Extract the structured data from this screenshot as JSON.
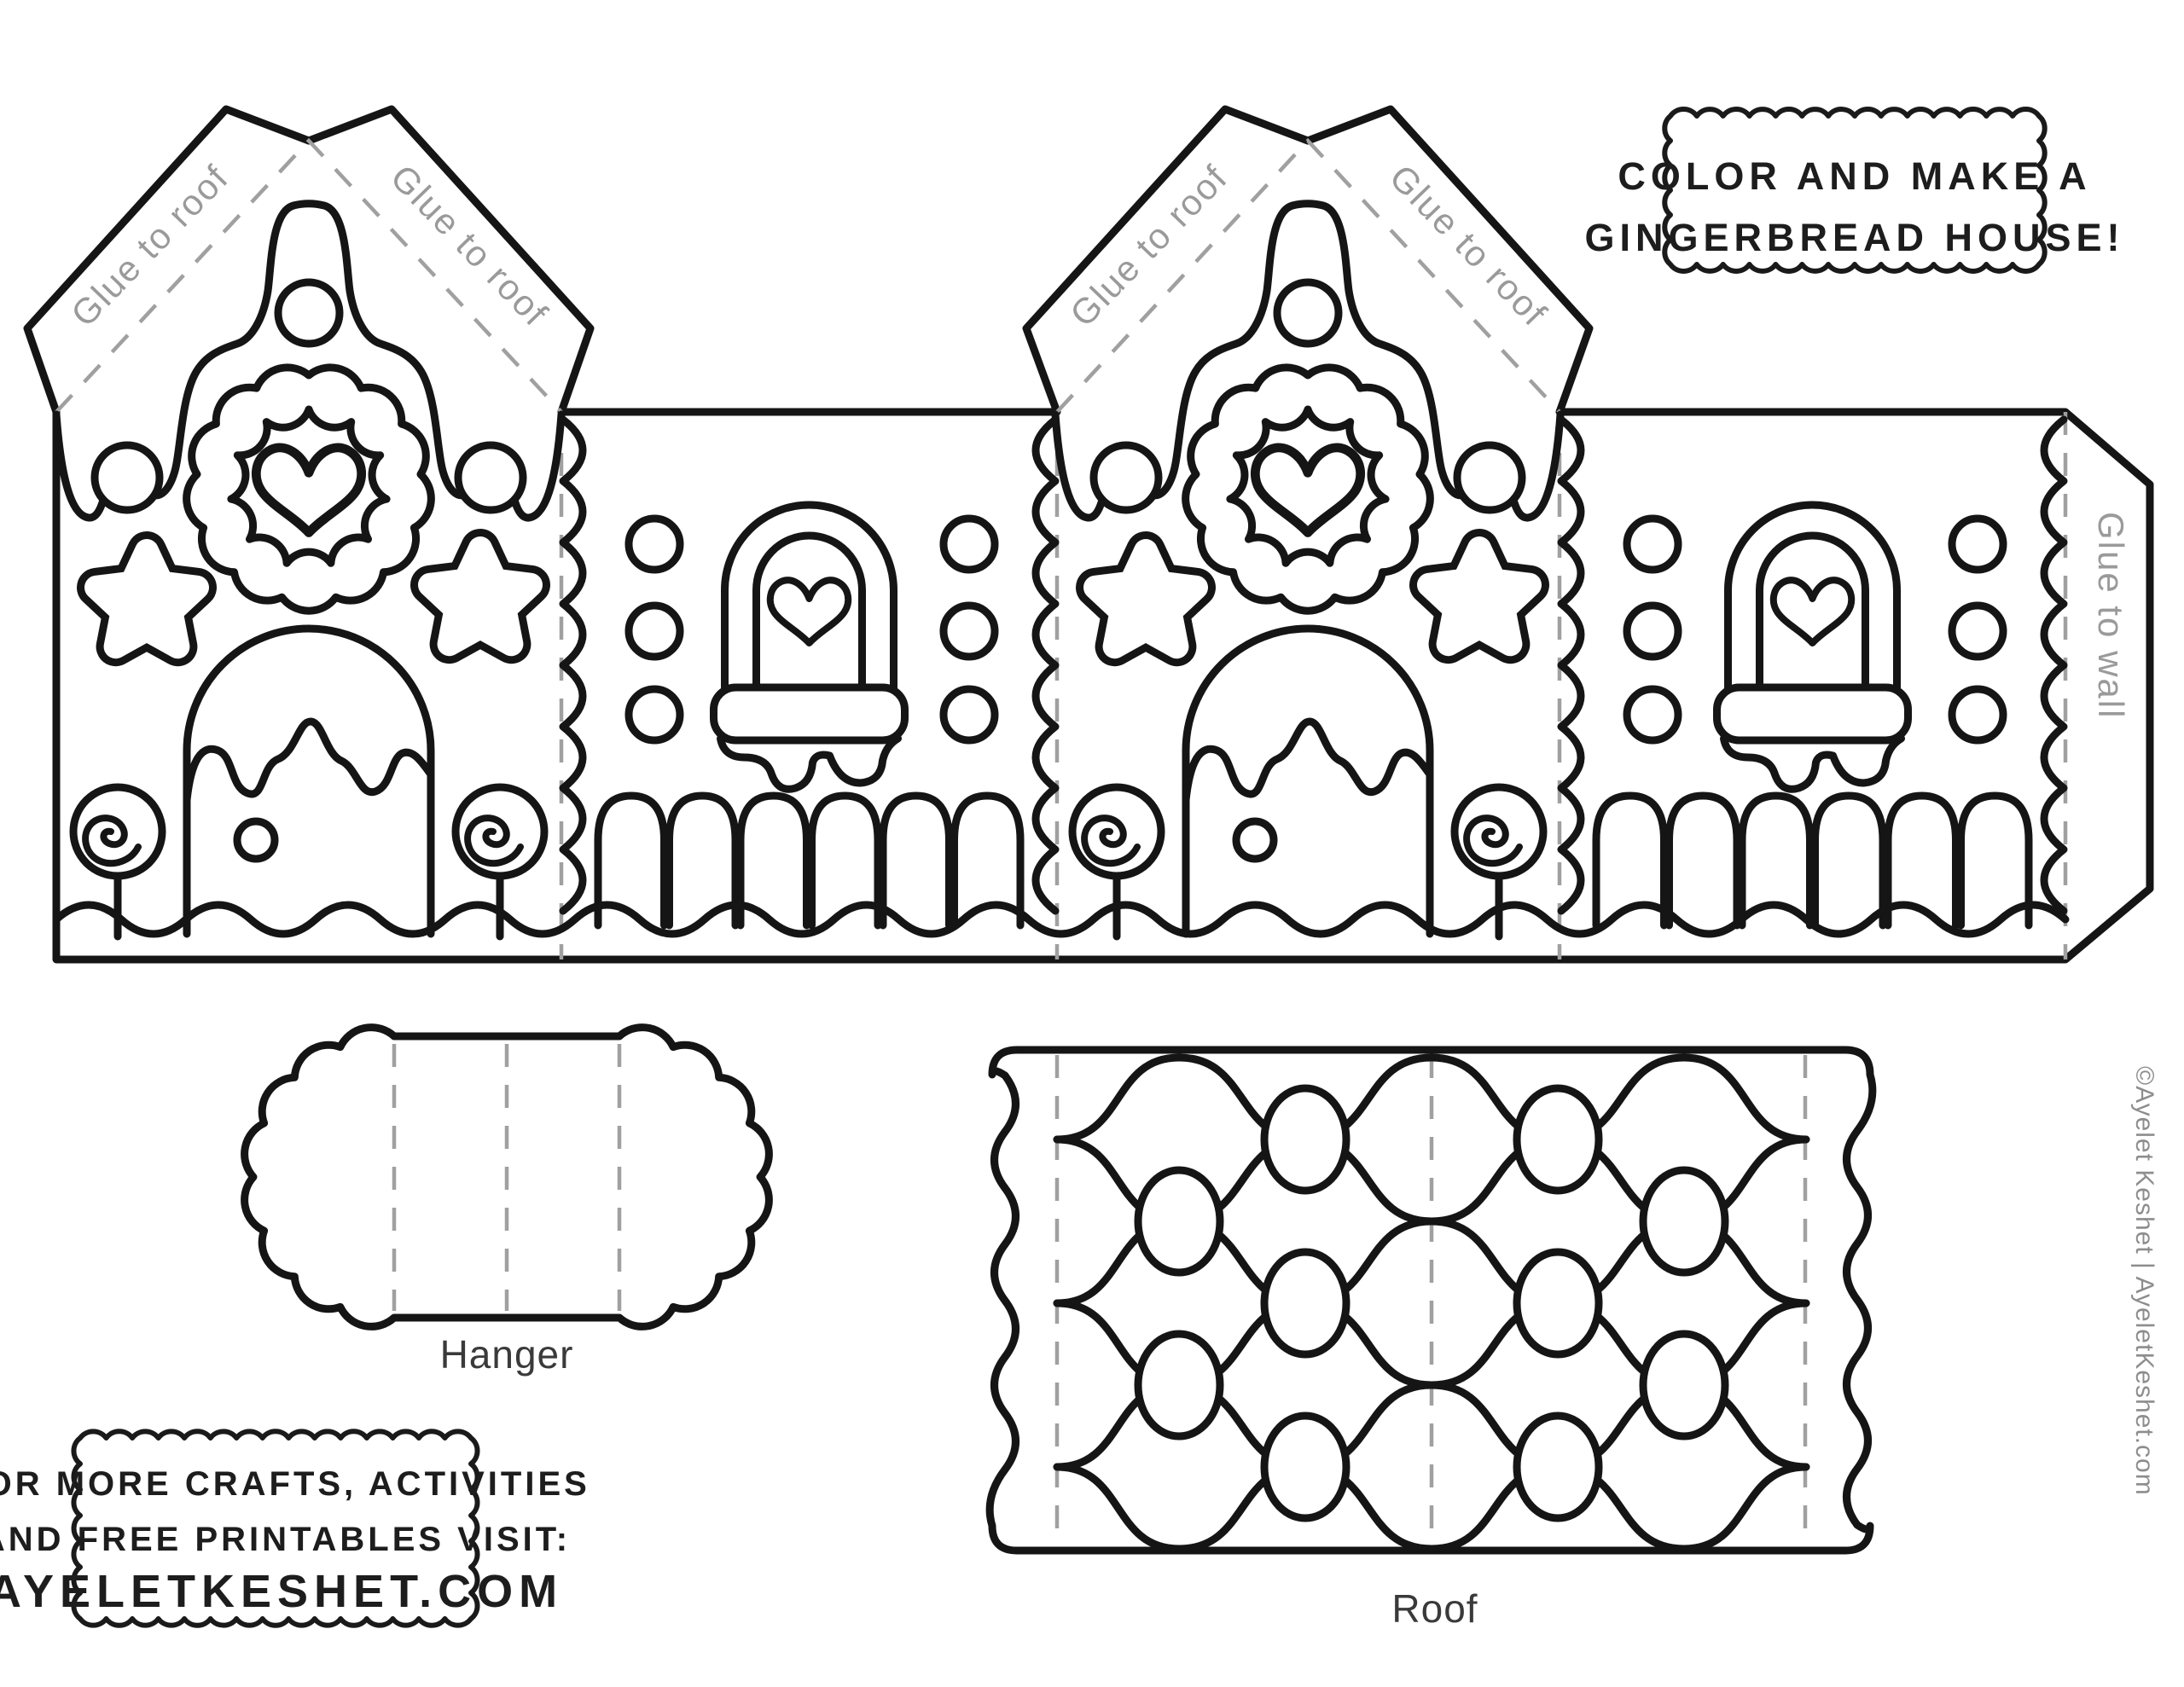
{
  "page": {
    "background": "#ffffff",
    "ink_color": "#151515",
    "fold_line_color": "#a0a0a0",
    "glue_text_color": "#9a9a9a"
  },
  "header_note": {
    "line1": "COLOR AND MAKE A",
    "line2": "GINGERBREAD HOUSE!"
  },
  "template_labels": {
    "glue_to_roof": "Glue to roof",
    "glue_to_wall": "Glue to wall"
  },
  "pieces": {
    "hanger_label": "Hanger",
    "roof_label": "Roof"
  },
  "footer_box": {
    "line1": "FOR MORE CRAFTS, ACTIVITIES",
    "line2": "AND FREE PRINTABLES VISIT:",
    "line3": "AYELETKESHET.COM"
  },
  "credit": "©Ayelet Keshet | AyeletKeshet.com"
}
